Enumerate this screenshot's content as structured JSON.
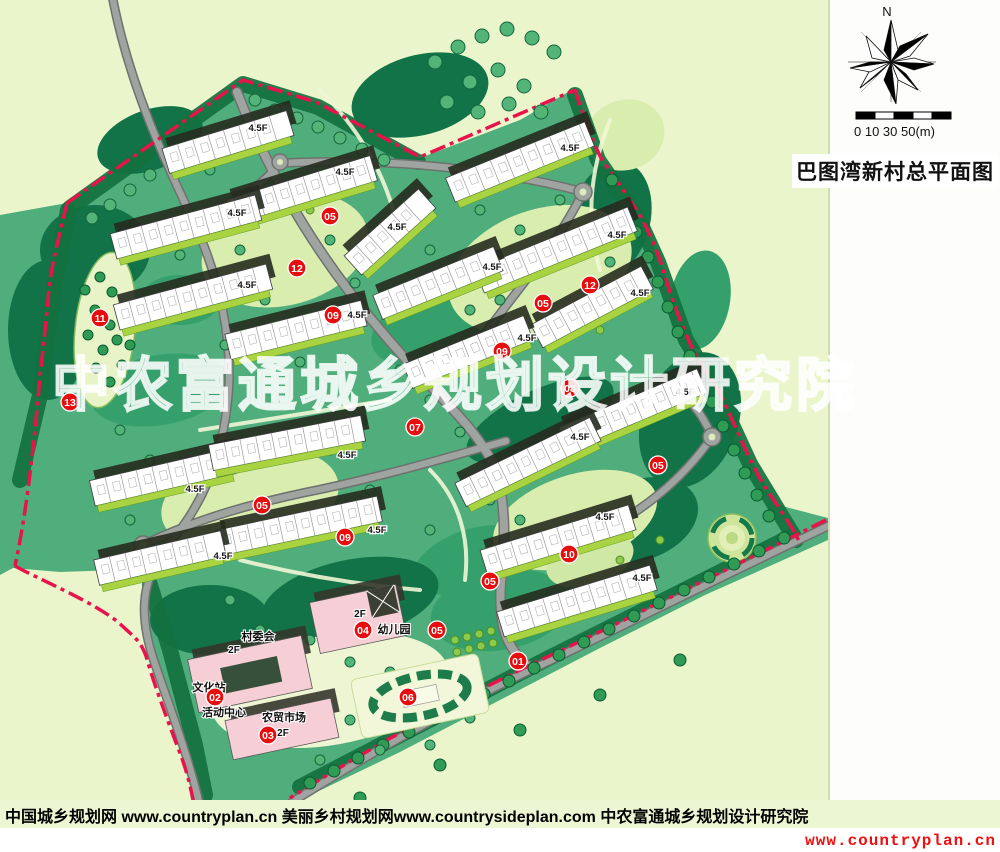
{
  "panel": {
    "north_label": "N",
    "scale_label": "0 10  30  50(m)",
    "title": "巴图湾新村总平面图",
    "legend": [
      "01、主入口",
      "02、文化站",
      "03、农贸市场",
      "04、幼儿园",
      "05、停车场",
      "06、入口广场",
      "07、中央景观大道",
      "08、林下漫步带",
      "09、住宅楼",
      "10、休闲草坪",
      "11、次入口景观节点",
      "12、公共活动区域",
      "13、绿化景观"
    ]
  },
  "footer": {
    "credits": "中国城乡规划网 www.countryplan.cn  美丽乡村规划网www.countrysideplan.com    中农富通城乡规划设计研究院",
    "url_red": "www.countryplan.cn"
  },
  "map": {
    "watermark": "中农富通城乡规划设计研究院",
    "floor_label_text": "4.5F",
    "colors": {
      "boundary_red": "#e8134b",
      "badge_red": "#e70d0e",
      "road_gray": "#a0a4a0",
      "site_green": "#4fae7c",
      "outside_pale": "#eaf5cc",
      "building_white": "#ffffff",
      "public_pink": "#f6cfd6",
      "lawn_light": "#d9edae"
    },
    "badges": [
      {
        "n": "01",
        "x": 518,
        "y": 661
      },
      {
        "n": "02",
        "x": 215,
        "y": 697
      },
      {
        "n": "03",
        "x": 268,
        "y": 735
      },
      {
        "n": "04",
        "x": 363,
        "y": 630
      },
      {
        "n": "05",
        "x": 330,
        "y": 216
      },
      {
        "n": "05",
        "x": 543,
        "y": 303
      },
      {
        "n": "05",
        "x": 658,
        "y": 465
      },
      {
        "n": "05",
        "x": 262,
        "y": 505
      },
      {
        "n": "05",
        "x": 490,
        "y": 581
      },
      {
        "n": "05",
        "x": 437,
        "y": 630
      },
      {
        "n": "06",
        "x": 408,
        "y": 697
      },
      {
        "n": "07",
        "x": 415,
        "y": 427
      },
      {
        "n": "08",
        "x": 570,
        "y": 388
      },
      {
        "n": "09",
        "x": 333,
        "y": 315
      },
      {
        "n": "09",
        "x": 502,
        "y": 351
      },
      {
        "n": "09",
        "x": 345,
        "y": 537
      },
      {
        "n": "10",
        "x": 569,
        "y": 554
      },
      {
        "n": "11",
        "x": 100,
        "y": 318
      },
      {
        "n": "12",
        "x": 297,
        "y": 268
      },
      {
        "n": "12",
        "x": 590,
        "y": 285
      },
      {
        "n": "13",
        "x": 70,
        "y": 402
      }
    ],
    "floor_labels": [
      [
        258,
        128
      ],
      [
        345,
        172
      ],
      [
        237,
        213
      ],
      [
        247,
        285
      ],
      [
        357,
        315
      ],
      [
        397,
        227
      ],
      [
        570,
        148
      ],
      [
        617,
        235
      ],
      [
        492,
        267
      ],
      [
        640,
        293
      ],
      [
        527,
        338
      ],
      [
        195,
        489
      ],
      [
        347,
        455
      ],
      [
        377,
        530
      ],
      [
        223,
        556
      ],
      [
        685,
        392
      ],
      [
        580,
        437
      ],
      [
        605,
        517
      ],
      [
        642,
        578
      ]
    ],
    "place_labels": [
      {
        "t": "村委会",
        "x": 258,
        "y": 637,
        "s": 11
      },
      {
        "t": "2F",
        "x": 234,
        "y": 650,
        "s": 10
      },
      {
        "t": "文化站",
        "x": 209,
        "y": 688,
        "s": 11
      },
      {
        "t": "活动中心",
        "x": 224,
        "y": 713,
        "s": 11
      },
      {
        "t": "农贸市场",
        "x": 284,
        "y": 718,
        "s": 11
      },
      {
        "t": "2F",
        "x": 283,
        "y": 733,
        "s": 10
      },
      {
        "t": "2F",
        "x": 360,
        "y": 614,
        "s": 10
      },
      {
        "t": "幼儿园",
        "x": 394,
        "y": 630,
        "s": 11
      }
    ],
    "buildings": [
      [
        228,
        142,
        130,
        -17
      ],
      [
        302,
        190,
        150,
        -17
      ],
      [
        186,
        227,
        150,
        -15
      ],
      [
        193,
        297,
        158,
        -15
      ],
      [
        296,
        330,
        140,
        -14
      ],
      [
        390,
        232,
        100,
        -42
      ],
      [
        520,
        162,
        150,
        -22
      ],
      [
        556,
        250,
        165,
        -22
      ],
      [
        438,
        283,
        130,
        -22
      ],
      [
        592,
        307,
        125,
        -28
      ],
      [
        468,
        352,
        130,
        -22
      ],
      [
        163,
        477,
        145,
        -13
      ],
      [
        287,
        443,
        155,
        -11
      ],
      [
        299,
        526,
        165,
        -12
      ],
      [
        160,
        558,
        130,
        -13
      ],
      [
        633,
        410,
        150,
        -23
      ],
      [
        528,
        462,
        150,
        -26
      ],
      [
        558,
        540,
        155,
        -17
      ],
      [
        577,
        601,
        160,
        -17
      ]
    ]
  }
}
